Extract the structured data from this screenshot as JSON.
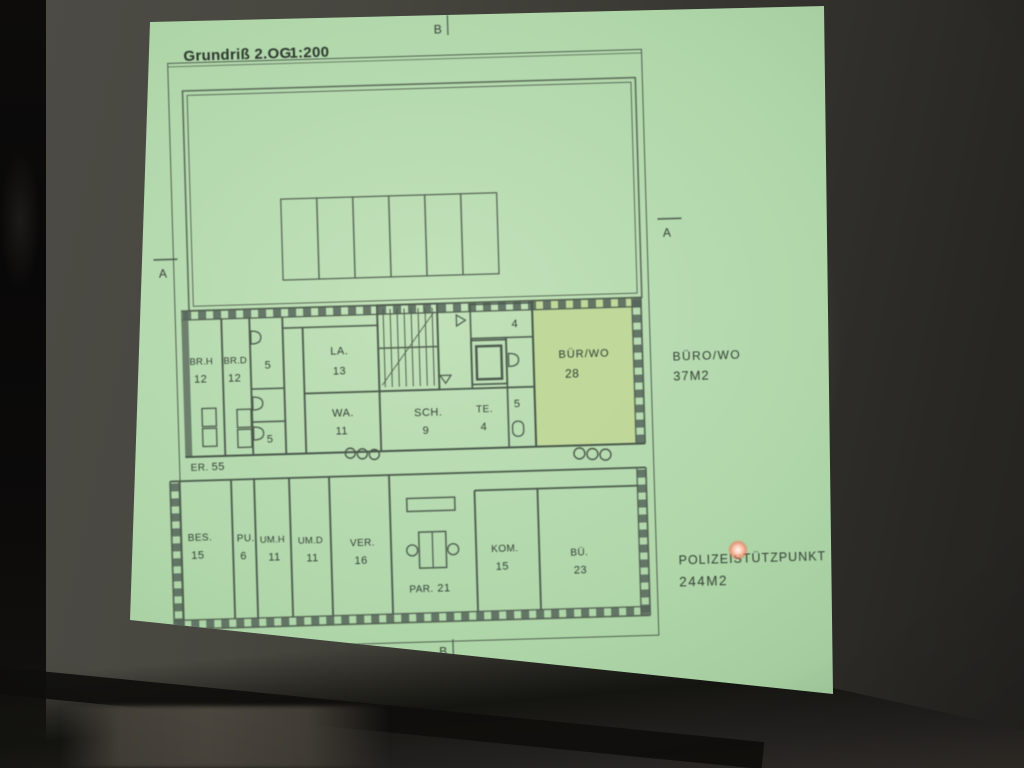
{
  "slide": {
    "title": "Grundriß 2.OG",
    "scale": "1:200",
    "section_markers": {
      "top": "B",
      "bottom": "B",
      "left": "A",
      "right": "A"
    },
    "upper_rooms": [
      {
        "name": "BR.H",
        "number": "12"
      },
      {
        "name": "BR.D",
        "number": "12"
      },
      {
        "name": "",
        "number": "5"
      },
      {
        "name": "",
        "number": "5"
      },
      {
        "name": "LA.",
        "number": "13"
      },
      {
        "name": "WA.",
        "number": "11"
      },
      {
        "name": "SCH.",
        "number": "9"
      },
      {
        "name": "TE.",
        "number": "4"
      },
      {
        "name": "",
        "number": "4"
      },
      {
        "name": "",
        "number": "5"
      },
      {
        "name": "BÜR/WO",
        "number": "28",
        "highlighted": true
      }
    ],
    "lower_rooms": [
      {
        "name": "BES.",
        "number": "15"
      },
      {
        "name": "PU.",
        "number": "6"
      },
      {
        "name": "UM.H",
        "number": "11"
      },
      {
        "name": "UM.D",
        "number": "11"
      },
      {
        "name": "VER.",
        "number": "16"
      },
      {
        "name": "PAR.",
        "number": "21"
      },
      {
        "name": "KOM.",
        "number": "15"
      },
      {
        "name": "BÜ.",
        "number": "23"
      }
    ],
    "corridor_label": {
      "name": "ER.",
      "number": "55"
    },
    "annotations": {
      "office": {
        "label": "BÜRO/WO",
        "area": "37M2"
      },
      "police": {
        "label": "POLIZEISTÜTZPUNKT",
        "area": "244M2"
      }
    },
    "colors": {
      "projection_green": "#b6dab0",
      "highlight_room": "#c1d795",
      "ink": "#333f33",
      "wall_line": "#51604f",
      "laser_dot": "#ff6a55"
    }
  }
}
